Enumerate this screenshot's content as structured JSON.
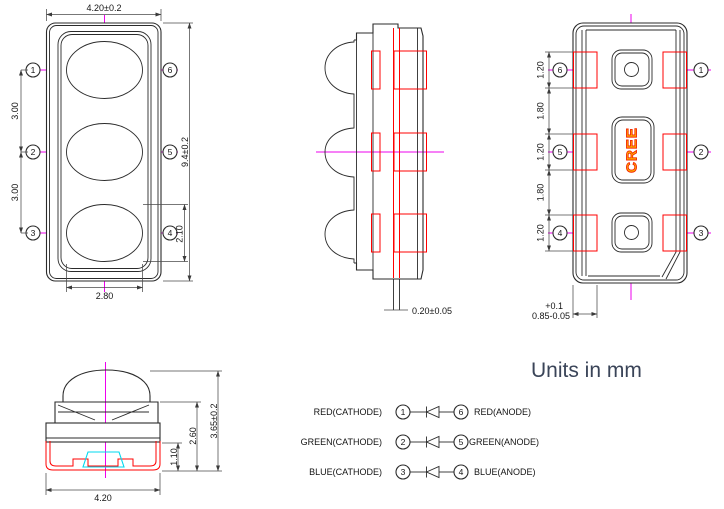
{
  "note": {
    "units": "Units in mm"
  },
  "brand": {
    "name": "CREE"
  },
  "colors": {
    "line": "#2b2b2b",
    "dimension": "#4a4a4a",
    "centerline_magenta": "#ee00ee",
    "lead_red": "#ff0000",
    "die_cyan": "#00d8ef",
    "brand_fill": "#ffb300",
    "brand_stroke": "#f32400",
    "note_text": "#3a4458"
  },
  "front_view": {
    "dim_width": "4.20±0.2",
    "dim_height": "9.4±0.2",
    "dim_pitch_upper": "3.00",
    "dim_pitch_lower": "3.00",
    "dim_lens_width": "2.80",
    "dim_lens_height": "2.10",
    "pins_left": [
      "1",
      "2",
      "3"
    ],
    "pins_right": [
      "6",
      "5",
      "4"
    ]
  },
  "side_view": {
    "dim_lead_thickness": "0.20±0.05"
  },
  "back_view": {
    "pins_left": [
      "6",
      "5",
      "4"
    ],
    "pins_right": [
      "1",
      "2",
      "3"
    ],
    "dims_left": [
      "1.20",
      "1.80",
      "1.20",
      "1.80",
      "1.20"
    ],
    "dim_pad_tol": "+0.1",
    "dim_pad": "0.85-0.05"
  },
  "end_view": {
    "dim_width": "4.20",
    "dim_clip_height": "1.10",
    "dim_body_height": "2.60",
    "dim_total_height": "3.65±0.2"
  },
  "pinout": {
    "rows": [
      {
        "cathode_label": "RED(CATHODE)",
        "cathode_pin": "1",
        "anode_pin": "6",
        "anode_label": "RED(ANODE)"
      },
      {
        "cathode_label": "GREEN(CATHODE)",
        "cathode_pin": "2",
        "anode_pin": "5",
        "anode_label": "GREEN(ANODE)"
      },
      {
        "cathode_label": "BLUE(CATHODE)",
        "cathode_pin": "3",
        "anode_pin": "4",
        "anode_label": "BLUE(ANODE)"
      }
    ]
  }
}
